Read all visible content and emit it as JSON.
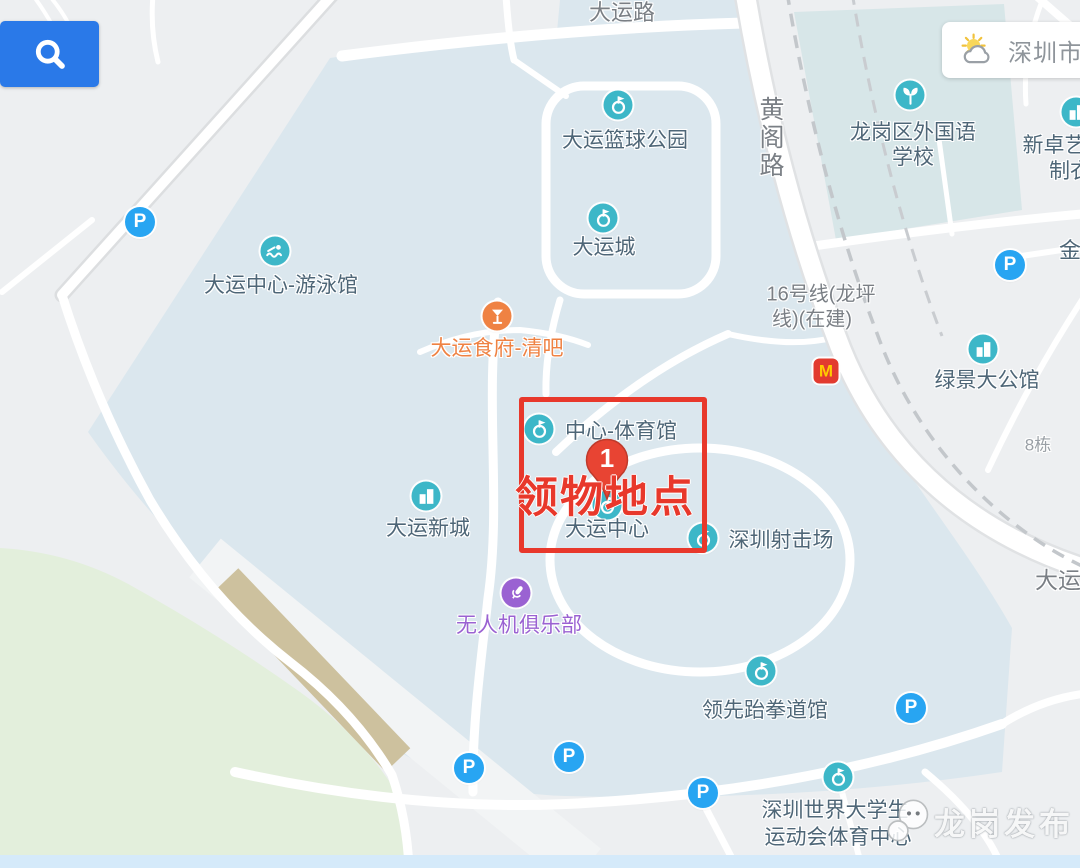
{
  "weather": {
    "city": "深圳市"
  },
  "watermark": {
    "text": "龙岗发布"
  },
  "annotation": {
    "label": "领物地点",
    "pin_number": "1",
    "box": {
      "x": 519,
      "y": 397,
      "w": 178,
      "h": 146
    },
    "pin": {
      "x": 607,
      "y": 436
    },
    "label_pos": {
      "x": 605,
      "y": 494
    },
    "color": "#e8382b"
  },
  "palette": {
    "poi_teal": "#3db7c8",
    "parking_blue": "#28a5f2",
    "food_orange": "#ef8243",
    "drone_purple": "#9a62d2",
    "mcdonalds_red": "#e23b2f",
    "search_blue": "#2a79e8",
    "label_blue_gray": "#4e6677",
    "road_gray": "#7a7f85"
  },
  "map": {
    "pois": [
      {
        "id": "dayun-basketball-park",
        "icon": "scenic",
        "ix": 618,
        "iy": 105,
        "lines": [
          {
            "t": "大运篮球公园",
            "x": 625,
            "y": 139
          }
        ]
      },
      {
        "id": "dayun-city",
        "icon": "scenic",
        "ix": 603,
        "iy": 218,
        "lines": [
          {
            "t": "大运城",
            "x": 604,
            "y": 246
          }
        ]
      },
      {
        "id": "longgang-foreign-language-school",
        "icon": "school",
        "ix": 910,
        "iy": 95,
        "lines": [
          {
            "t": "龙岗区外国语",
            "x": 913,
            "y": 131
          },
          {
            "t": "学校",
            "x": 913,
            "y": 156
          }
        ]
      },
      {
        "id": "xinzhuoyi-clothing",
        "icon": "building",
        "ix": 1076,
        "iy": 112,
        "lines": [
          {
            "t": "新卓艺",
            "x": 1054,
            "y": 144
          },
          {
            "t": "制衣",
            "x": 1070,
            "y": 170
          }
        ]
      },
      {
        "id": "dayun-swimming-hall",
        "icon": "swim",
        "ix": 275,
        "iy": 251,
        "lines": [
          {
            "t": "大运中心-游泳馆",
            "x": 281,
            "y": 284
          }
        ]
      },
      {
        "id": "dayun-restaurant-bar",
        "icon": "food",
        "color": "#ef8243",
        "ix": 497,
        "iy": 316,
        "lines": [
          {
            "t": "大运食府-清吧",
            "x": 497,
            "y": 347
          }
        ]
      },
      {
        "id": "lvjing-mansion",
        "icon": "building",
        "ix": 983,
        "iy": 349,
        "lines": [
          {
            "t": "绿景大公馆",
            "x": 987,
            "y": 379
          }
        ]
      },
      {
        "id": "center-gymnasium",
        "icon": "scenic",
        "ix": 539,
        "iy": 429,
        "lines": [
          {
            "t": "中心-体育馆",
            "x": 621,
            "y": 430
          }
        ]
      },
      {
        "id": "dayun-center",
        "icon": "scenic",
        "ix": 607,
        "iy": 505,
        "lines": [
          {
            "t": "大运中心",
            "x": 607,
            "y": 528
          }
        ]
      },
      {
        "id": "shenzhen-shooting-range",
        "icon": "scenic",
        "ix": 703,
        "iy": 538,
        "lines": [
          {
            "t": "深圳射击场",
            "x": 781,
            "y": 539
          }
        ]
      },
      {
        "id": "dayun-new-town",
        "icon": "building",
        "ix": 426,
        "iy": 496,
        "lines": [
          {
            "t": "大运新城",
            "x": 428,
            "y": 527
          }
        ]
      },
      {
        "id": "drone-club",
        "icon": "drone",
        "color": "#9a62d2",
        "ix": 516,
        "iy": 593,
        "lines": [
          {
            "t": "无人机俱乐部",
            "x": 519,
            "y": 624
          }
        ]
      },
      {
        "id": "lingxian-taekwondo",
        "icon": "scenic",
        "ix": 761,
        "iy": 671,
        "lines": [
          {
            "t": "领先跆拳道馆",
            "x": 765,
            "y": 709
          }
        ]
      },
      {
        "id": "universiade-sports-center",
        "icon": "scenic",
        "ix": 838,
        "iy": 777,
        "lines": [
          {
            "t": "深圳世界大学生",
            "x": 835,
            "y": 809
          },
          {
            "t": "运动会体育中心",
            "x": 838,
            "y": 836
          }
        ]
      },
      {
        "id": "mcdonalds",
        "icon": "mcd",
        "ix": 826,
        "iy": 371,
        "lines": []
      }
    ],
    "labels": [
      {
        "t": "大运路",
        "x": 622,
        "y": 11,
        "cls": "road",
        "size": 22
      },
      {
        "t": "黄阁路",
        "x": 770,
        "y": 138,
        "cls": "road",
        "vertical": true,
        "size": 25
      },
      {
        "t": "16号线(龙坪",
        "x": 821,
        "y": 292,
        "cls": "road",
        "size": 20
      },
      {
        "t": "线)(在建)",
        "x": 812,
        "y": 317,
        "cls": "road",
        "size": 20
      },
      {
        "t": "大运",
        "x": 1058,
        "y": 578,
        "cls": "road",
        "size": 23
      },
      {
        "t": "8栋",
        "x": 1038,
        "y": 443,
        "cls": "road",
        "size": 17,
        "color": "#9aa0a6"
      },
      {
        "t": "金",
        "x": 1070,
        "y": 249,
        "cls": "poi",
        "size": 22
      }
    ],
    "parking": [
      [
        140,
        222
      ],
      [
        1010,
        265
      ],
      [
        911,
        708
      ],
      [
        569,
        757
      ],
      [
        469,
        768
      ],
      [
        703,
        793
      ]
    ]
  }
}
